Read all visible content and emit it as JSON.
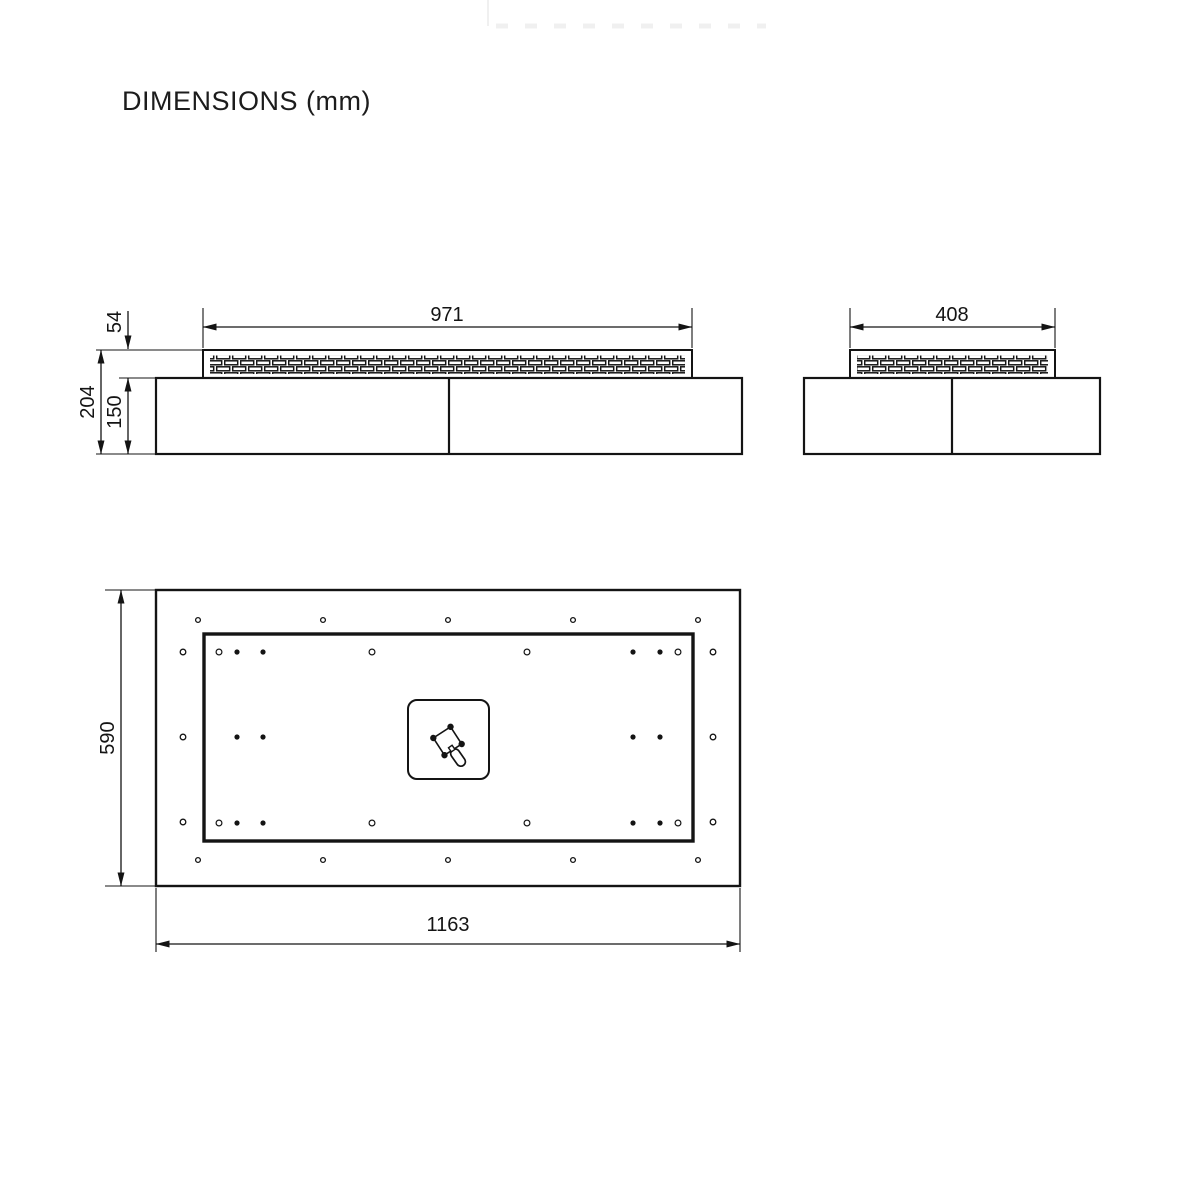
{
  "title": "DIMENSIONS (mm)",
  "units": "mm",
  "dimensions": {
    "front_burner_width": "971",
    "front_tray_height": "54",
    "front_total_height": "204",
    "front_base_height": "150",
    "side_burner_width": "408",
    "top_depth": "590",
    "top_total_width": "1163"
  },
  "colors": {
    "line": "#141414",
    "background": "#ffffff"
  },
  "icons": {
    "center_icon": "gas-valve-icon",
    "hole_filled": "fastener-dot",
    "hole_ring": "mounting-hole"
  }
}
